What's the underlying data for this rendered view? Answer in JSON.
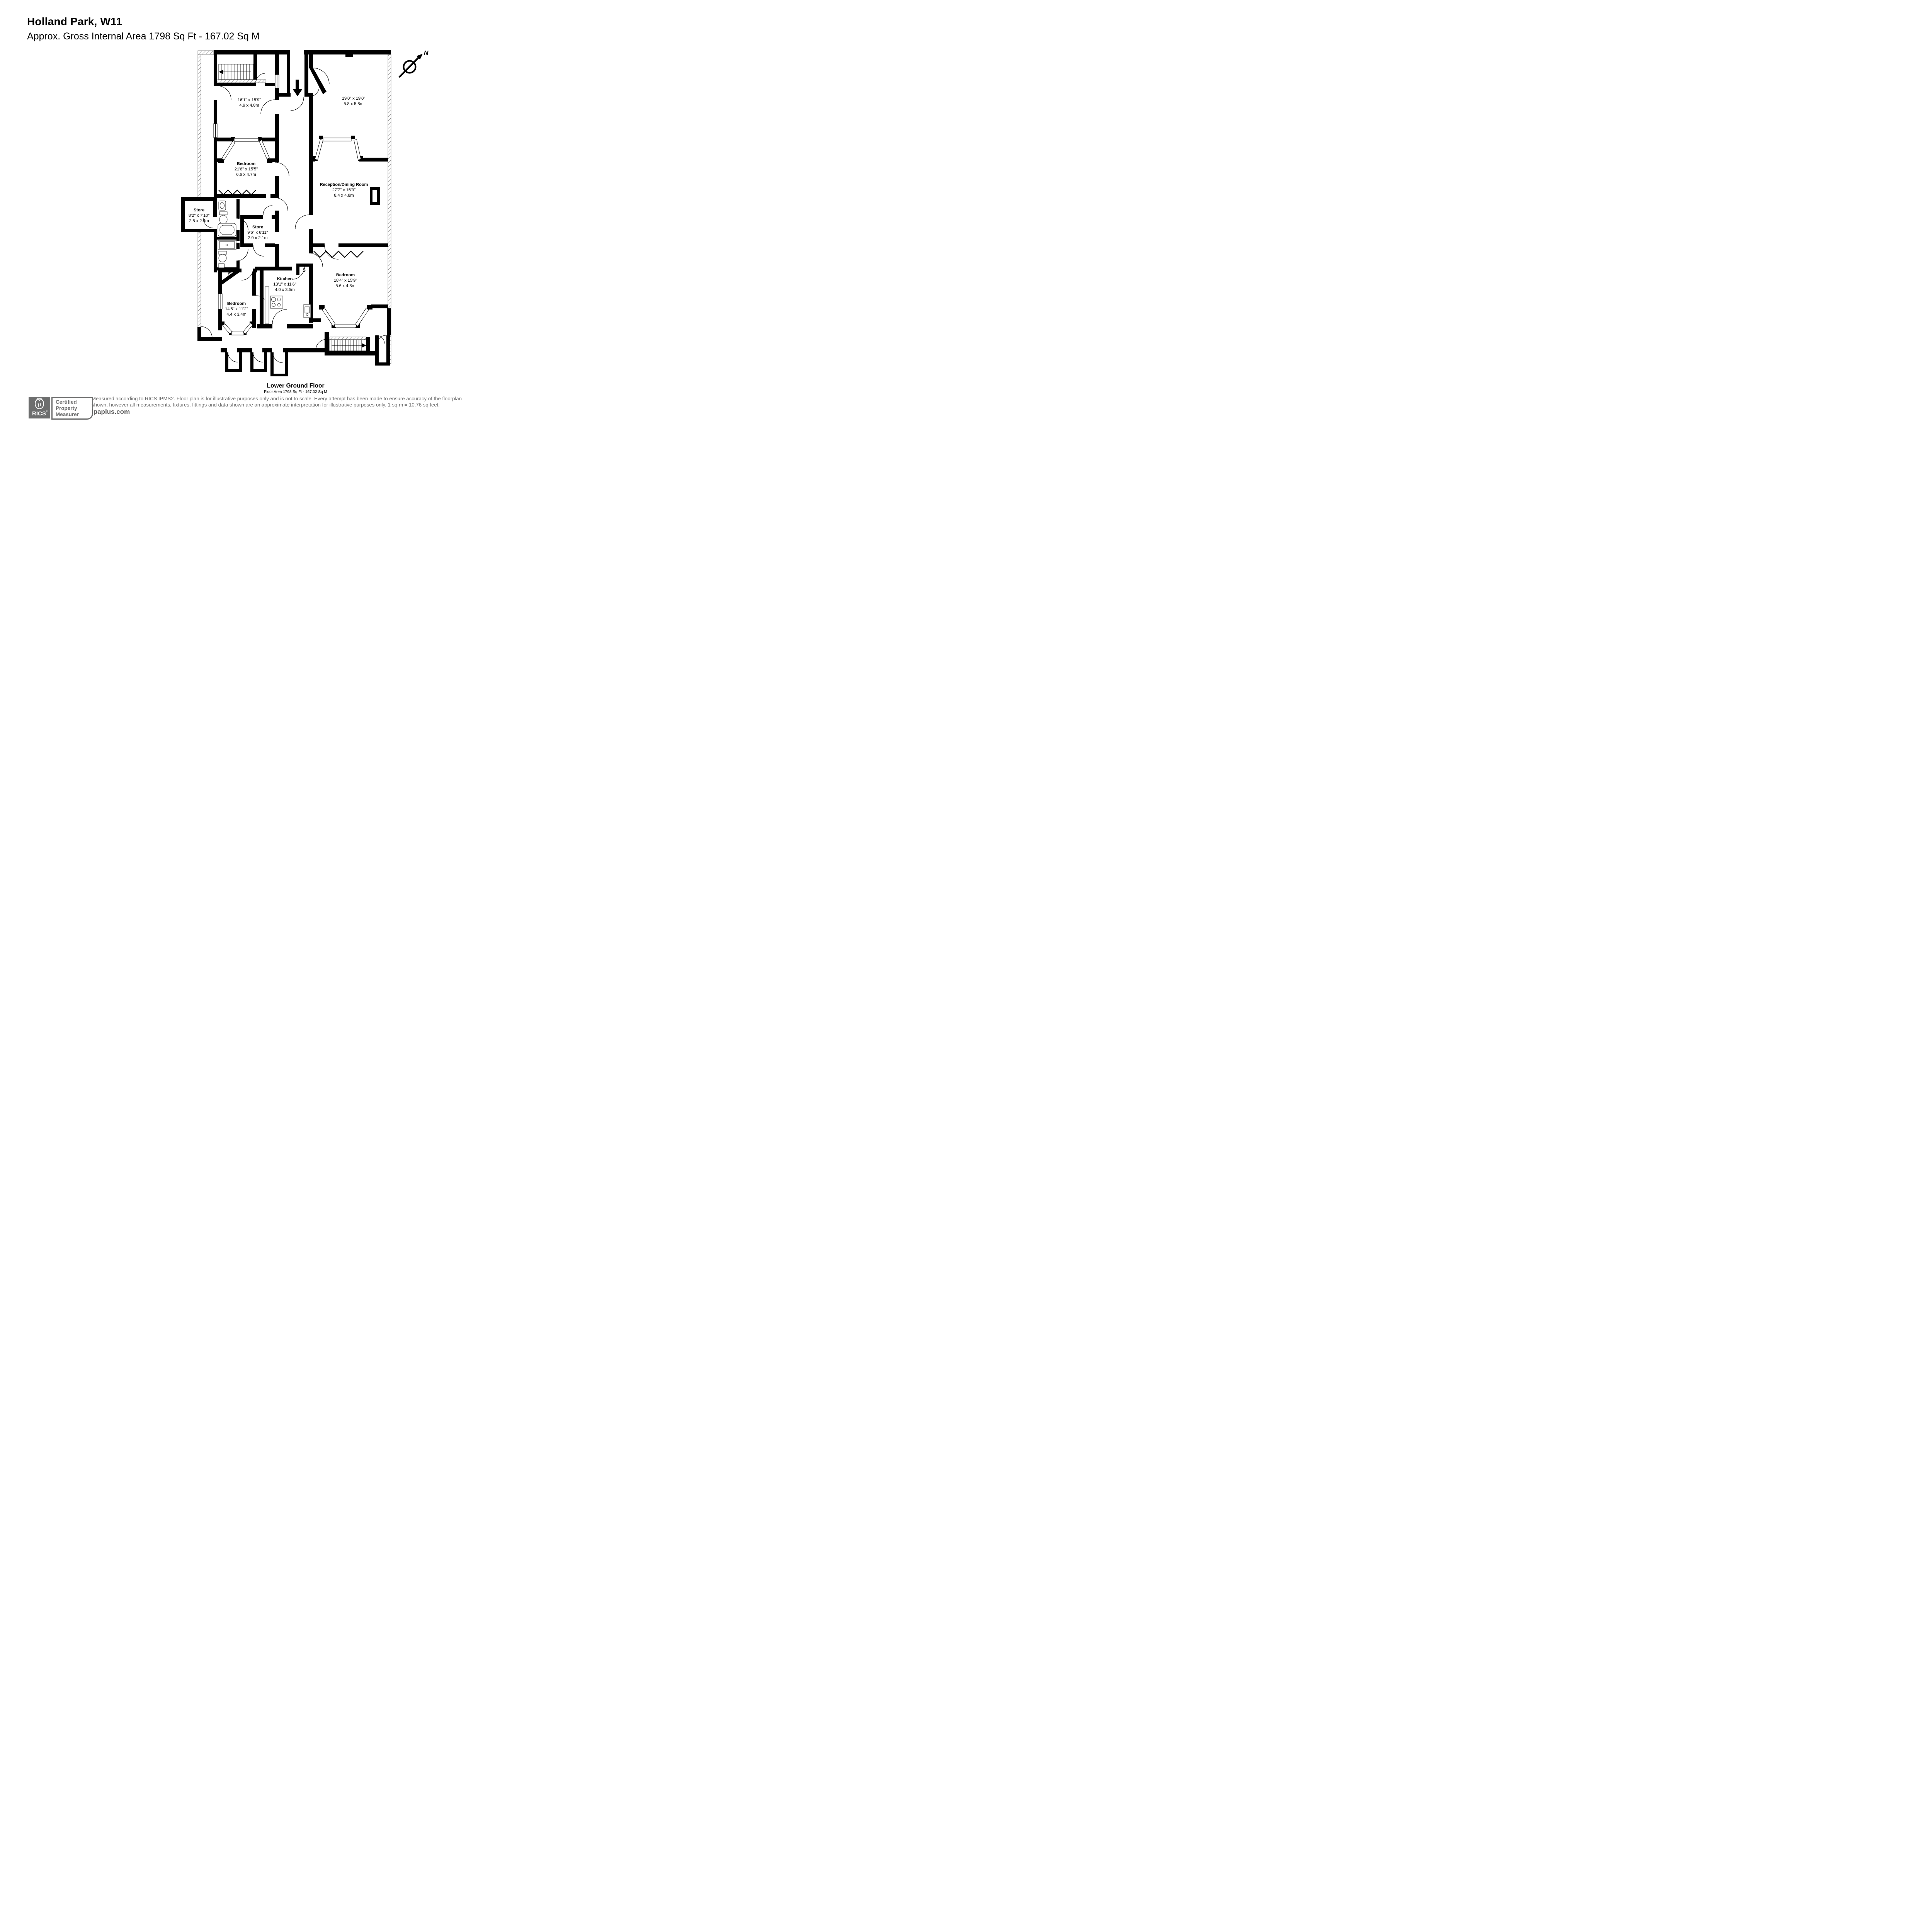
{
  "header": {
    "title": "Holland Park, W11",
    "subtitle": "Approx. Gross Internal Area 1798 Sq Ft - 167.02 Sq M"
  },
  "compass": {
    "north_label": "N"
  },
  "rooms": {
    "front_room": {
      "name": "",
      "imperial": "16'1\" x 15'9\"",
      "metric": "4.9 x 4.8m"
    },
    "rear_room": {
      "name": "",
      "imperial": "19'0\" x 19'0\"",
      "metric": "5.8 x 5.8m"
    },
    "bedroom_main": {
      "name": "Bedroom",
      "imperial": "21'8\" x 15'5\"",
      "metric": "6.6 x 4.7m"
    },
    "reception": {
      "name": "Reception/Dining Room",
      "imperial": "27'7\" x 15'9\"",
      "metric": "8.4 x 4.8m"
    },
    "store_left": {
      "name": "Store",
      "imperial": "8'2\" x 7'10\"",
      "metric": "2.5 x 2.4m"
    },
    "store_mid": {
      "name": "Store",
      "imperial": "9'6\" x 6'11\"",
      "metric": "2.9 x 2.1m"
    },
    "kitchen": {
      "name": "Kitchen",
      "imperial": "13'1\" x 11'6\"",
      "metric": "4.0 x 3.5m"
    },
    "bedroom_right": {
      "name": "Bedroom",
      "imperial": "18'4\" x 15'9\"",
      "metric": "5.6 x 4.8m"
    },
    "bedroom_lower": {
      "name": "Bedroom",
      "imperial": "14'5\" x 11'2\"",
      "metric": "4.4 x 3.4m"
    }
  },
  "cupboards": {
    "left": "S",
    "right": "S"
  },
  "floor": {
    "name": "Lower Ground Floor",
    "area_line": "Floor Area 1798 Sq Ft - 167.02 Sq M"
  },
  "footer": {
    "rics": "RICS",
    "rics_reg": "®",
    "badge_line1": "Certified",
    "badge_line2": "Property",
    "badge_line3": "Measurer",
    "disclaimer_line1": "Measured according to RICS IPMS2. Floor plan is for illustrative purposes only and is not to scale. Every attempt has been made to ensure accuracy of the floorplan",
    "disclaimer_line2": "shown, however all measurements, fixtures, fittings and data shown are an approximate interpretation for illustrative purposes only. 1 sq m = 10.76 sq feet.",
    "website": "lpaplus.com"
  },
  "colors": {
    "wall": "#000000",
    "footer_text": "#686868",
    "rics_gray": "#6d6e6e"
  }
}
